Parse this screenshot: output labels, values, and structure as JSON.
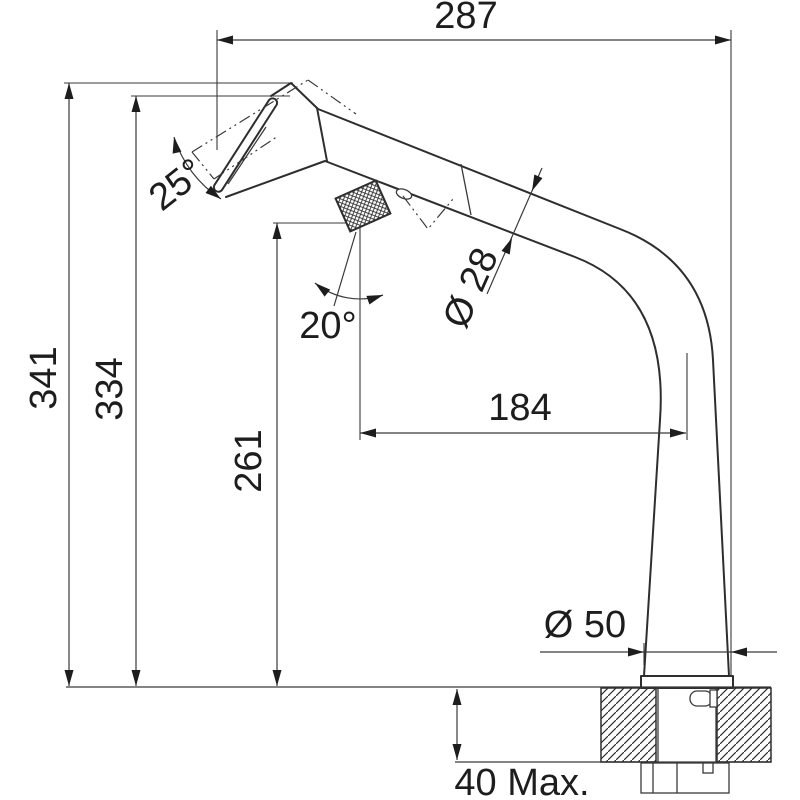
{
  "drawing": {
    "type": "technical-dimension-drawing",
    "subject": "pull-out kitchen faucet side elevation with installation dimensions",
    "background_color": "#ffffff",
    "line_color": "#2e2e2e",
    "text_color": "#1d1d1d",
    "units": "mm",
    "labels": {
      "total_width": "287",
      "total_height": "341",
      "spout_height": "334",
      "handle_height": "261",
      "spout_reach": "184",
      "head_swivel_angle": "25°",
      "handle_swivel_angle": "20°",
      "spout_diameter": "Ø 28",
      "base_diameter": "Ø 50",
      "counter_thickness_max": "40 Max."
    }
  }
}
